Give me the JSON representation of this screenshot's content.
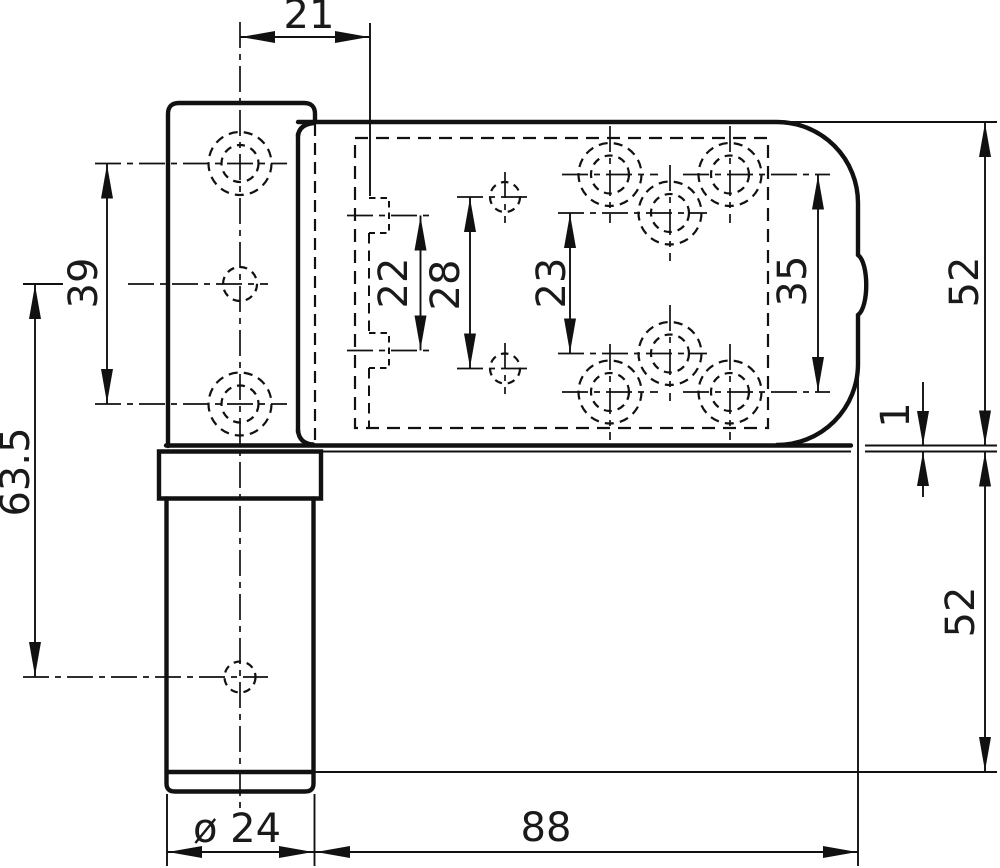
{
  "drawing": {
    "background": "#ffffff",
    "line_color": "#111111",
    "labels": {
      "dim_21": "21",
      "dim_39": "39",
      "dim_63_5": "63.5",
      "dim_22": "22",
      "dim_28": "28",
      "dim_23": "23",
      "dim_35": "35",
      "dim_52_top": "52",
      "dim_1": "1",
      "dim_52_bottom": "52",
      "dim_dia_24": "ø 24",
      "dim_88": "88"
    }
  }
}
